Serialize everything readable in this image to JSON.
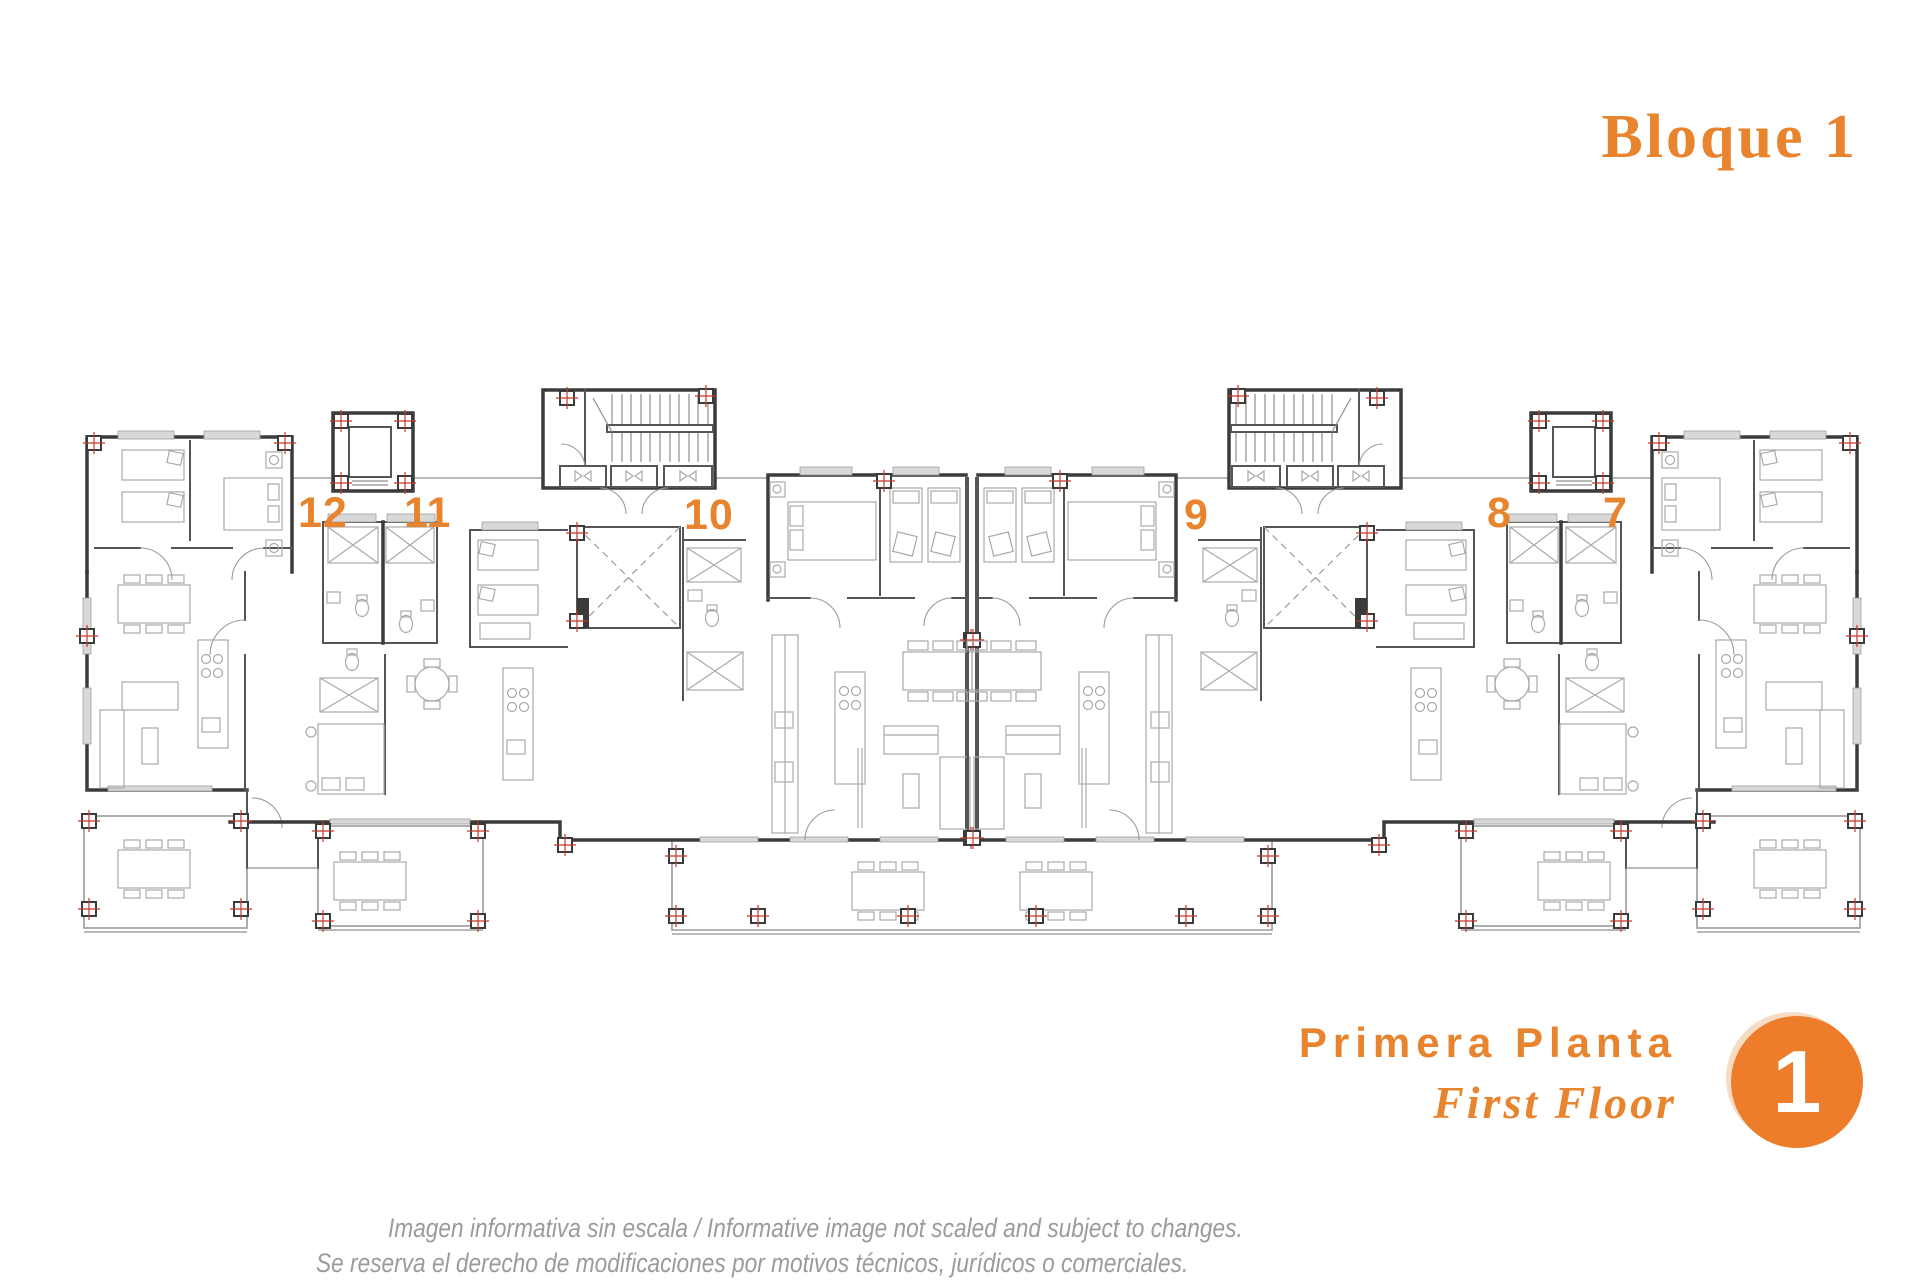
{
  "colors": {
    "accent": "#e8832e",
    "badge": "#ed7c2b",
    "badge-text": "#ffffff",
    "wall": "#3b3b3b",
    "wall2": "#555555",
    "line": "#8f8f8f",
    "furniture": "#a9a9a9",
    "sill": "#d8d8d8",
    "cross": "#c0392b",
    "disclaimer": "#9b9b9b"
  },
  "header": {
    "title": "Bloque 1"
  },
  "floor": {
    "label_es": "Primera Planta",
    "label_en": "First Floor",
    "badge": "1"
  },
  "plan": {
    "apartments": [
      {
        "number": "12"
      },
      {
        "number": "11"
      },
      {
        "number": "10"
      },
      {
        "number": "9"
      },
      {
        "number": "8"
      },
      {
        "number": "7"
      }
    ]
  },
  "disclaimer": {
    "line1": "Imagen informativa sin escala /  Informative image not scaled and subject to changes.",
    "line2": "Se reserva el derecho de modificaciones por motivos técnicos, jurídicos o comerciales."
  }
}
